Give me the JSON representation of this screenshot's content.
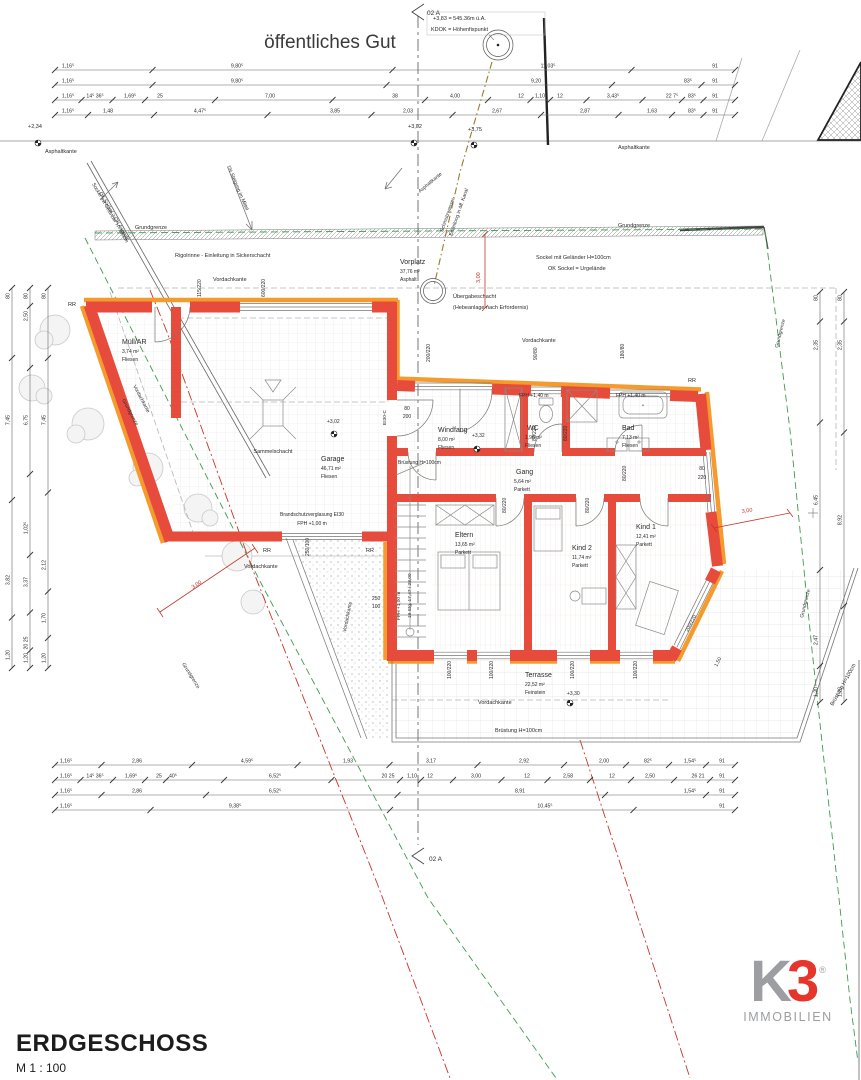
{
  "title": {
    "name": "ERDGESCHOSS",
    "scale": "M 1 : 100"
  },
  "logo": {
    "k": "K",
    "three": "3",
    "reg": "®",
    "sub": "IMMOBILIEN",
    "gray": "#9c9ea1",
    "red": "#e6352b"
  },
  "colors": {
    "wall_red": "#e64b3c",
    "insulation_orange": "#f59b2d",
    "dim_red": "#c0392b",
    "boundary_green": "#3f9b4f",
    "line_gray": "#555555",
    "text": "#2b2b2b"
  },
  "annotations": [
    {
      "t": "öffentliches Gut",
      "x": 330,
      "y": 48,
      "s": 19,
      "a": "middle",
      "c": "#3a3a3a"
    },
    {
      "t": "02 A",
      "x": 427,
      "y": 15,
      "s": 6.5
    },
    {
      "t": "+3,83 = 545.36m ü.A.",
      "x": 433,
      "y": 20,
      "s": 5.5
    },
    {
      "t": "KDOK = Höhenfixpunkt",
      "x": 431,
      "y": 31,
      "s": 5.5
    },
    {
      "t": "+2,34",
      "x": 28,
      "y": 128,
      "s": 5.5
    },
    {
      "t": "+3,02",
      "x": 408,
      "y": 128,
      "s": 5.5
    },
    {
      "t": "+3,75",
      "x": 468,
      "y": 131,
      "s": 5.5
    },
    {
      "t": "Asphaltkante",
      "x": 45,
      "y": 153,
      "s": 5.5
    },
    {
      "t": "Asphaltkante",
      "x": 618,
      "y": 149,
      "s": 5.5
    },
    {
      "t": "Asphaltkante",
      "x": 420,
      "y": 193,
      "s": 5,
      "r": -40
    },
    {
      "t": "Schmutzwasser-",
      "x": 443,
      "y": 232,
      "s": 5,
      "r": -71
    },
    {
      "t": "Einleitung in öff. Kanal",
      "x": 452,
      "y": 236,
      "s": 5,
      "r": -71
    },
    {
      "t": "1% Steigung im Mittel",
      "x": 227,
      "y": 166,
      "s": 5,
      "r": 67
    },
    {
      "t": "Sockel mit Geländer H=100cm",
      "x": 92,
      "y": 184,
      "s": 5,
      "r": 60
    },
    {
      "t": "OK Sockel > OK Asphalt",
      "x": 99,
      "y": 193,
      "s": 5,
      "r": 60
    },
    {
      "t": "Grundgrenze",
      "x": 135,
      "y": 229,
      "s": 5.5
    },
    {
      "t": "Grundgrenze",
      "x": 618,
      "y": 227,
      "s": 5.5
    },
    {
      "t": "Rigolrinne - Einleitung in Sickerschacht",
      "x": 175,
      "y": 257,
      "s": 5.5
    },
    {
      "t": "Sockel mit Geländer H=100cm",
      "x": 536,
      "y": 259,
      "s": 5.5
    },
    {
      "t": "OK Sockel = Urgelände",
      "x": 548,
      "y": 270,
      "s": 5.5
    },
    {
      "t": "Vorplatz",
      "x": 400,
      "y": 264,
      "s": 7
    },
    {
      "t": "37,76 m²",
      "x": 400,
      "y": 273,
      "s": 5
    },
    {
      "t": "Asphalt",
      "x": 400,
      "y": 281,
      "s": 5
    },
    {
      "t": "Übergabeschacht",
      "x": 453,
      "y": 298,
      "s": 5.5
    },
    {
      "t": "(Hebeanlage nach Erfordernis)",
      "x": 453,
      "y": 309,
      "s": 5.5
    },
    {
      "t": "3,00",
      "x": 480,
      "y": 283,
      "s": 5.5,
      "r": -90,
      "c": "#c0392b"
    },
    {
      "t": "Vordachkante",
      "x": 213,
      "y": 281,
      "s": 5.5
    },
    {
      "t": "Vordachkante",
      "x": 522,
      "y": 342,
      "s": 5.5
    },
    {
      "t": "Grundgrenze",
      "x": 778,
      "y": 348,
      "s": 5,
      "r": -76
    },
    {
      "t": "Grundgrenze",
      "x": 803,
      "y": 618,
      "s": 5,
      "r": -76
    },
    {
      "t": "Vordachkante",
      "x": 133,
      "y": 386,
      "s": 5,
      "r": 62
    },
    {
      "t": "Grundgrenze",
      "x": 122,
      "y": 400,
      "s": 5,
      "r": 62
    },
    {
      "t": "RR",
      "x": 68,
      "y": 306,
      "s": 5.5
    },
    {
      "t": "Müll/AR",
      "x": 122,
      "y": 344,
      "s": 7
    },
    {
      "t": "3,74 m²",
      "x": 122,
      "y": 353,
      "s": 5
    },
    {
      "t": "Fliesen",
      "x": 122,
      "y": 361,
      "s": 5
    },
    {
      "t": "115/220",
      "x": 201,
      "y": 297,
      "s": 5,
      "r": -90
    },
    {
      "t": "600/220",
      "x": 265,
      "y": 297,
      "s": 5,
      "r": -90
    },
    {
      "t": "Sammelschacht",
      "x": 273,
      "y": 453,
      "s": 5.5,
      "a": "middle"
    },
    {
      "t": "Garage",
      "x": 321,
      "y": 461,
      "s": 7
    },
    {
      "t": "46,71 m²",
      "x": 321,
      "y": 470,
      "s": 5
    },
    {
      "t": "Fliesen",
      "x": 321,
      "y": 478,
      "s": 5
    },
    {
      "t": "+3,02",
      "x": 327,
      "y": 423,
      "s": 5
    },
    {
      "t": "Brandschutzverglasung EI30",
      "x": 312,
      "y": 516,
      "s": 5,
      "a": "middle"
    },
    {
      "t": "FPH   +1,00 m",
      "x": 312,
      "y": 525,
      "s": 5,
      "a": "middle"
    },
    {
      "t": "EI30-C",
      "x": 386,
      "y": 425,
      "s": 4.8,
      "r": -90
    },
    {
      "t": "80",
      "x": 407,
      "y": 410,
      "s": 5,
      "a": "middle"
    },
    {
      "t": "200",
      "x": 407,
      "y": 418,
      "s": 5,
      "a": "middle"
    },
    {
      "t": "RR",
      "x": 263,
      "y": 552,
      "s": 5.5
    },
    {
      "t": "RR",
      "x": 366,
      "y": 552,
      "s": 5.5
    },
    {
      "t": "Vordachkante",
      "x": 244,
      "y": 568,
      "s": 5.5
    },
    {
      "t": "250/100",
      "x": 309,
      "y": 556,
      "s": 5,
      "r": -90
    },
    {
      "t": "250",
      "x": 372,
      "y": 600,
      "s": 5
    },
    {
      "t": "100",
      "x": 372,
      "y": 608,
      "s": 5
    },
    {
      "t": "Vordachkante",
      "x": 346,
      "y": 632,
      "s": 5,
      "r": -79
    },
    {
      "t": "3,00",
      "x": 193,
      "y": 589,
      "s": 5.5,
      "r": -34,
      "c": "#c0392b"
    },
    {
      "t": "Grundgrenze",
      "x": 182,
      "y": 664,
      "s": 5,
      "r": 58
    },
    {
      "t": "RR",
      "x": 688,
      "y": 382,
      "s": 5.5
    },
    {
      "t": "200/220",
      "x": 430,
      "y": 362,
      "s": 5,
      "r": -90
    },
    {
      "t": "90/80",
      "x": 537,
      "y": 360,
      "s": 5,
      "r": -90
    },
    {
      "t": "180/80",
      "x": 624,
      "y": 359,
      "s": 5,
      "r": -90
    },
    {
      "t": "Windfang",
      "x": 438,
      "y": 432,
      "s": 7
    },
    {
      "t": "8,00 m²",
      "x": 438,
      "y": 441,
      "s": 5
    },
    {
      "t": "Fliesen",
      "x": 438,
      "y": 449,
      "s": 5
    },
    {
      "t": "+3,32",
      "x": 472,
      "y": 437,
      "s": 5
    },
    {
      "t": "FPH   +1,40 m",
      "x": 519,
      "y": 397,
      "s": 5
    },
    {
      "t": "WC",
      "x": 527,
      "y": 430,
      "s": 7
    },
    {
      "t": "1,98 m²",
      "x": 525,
      "y": 439,
      "s": 5
    },
    {
      "t": "Fliesen",
      "x": 525,
      "y": 447,
      "s": 5
    },
    {
      "t": "FPH   +1,40 m",
      "x": 616,
      "y": 397,
      "s": 5
    },
    {
      "t": "Bad",
      "x": 622,
      "y": 430,
      "s": 7
    },
    {
      "t": "7,13 m²",
      "x": 622,
      "y": 439,
      "s": 5
    },
    {
      "t": "Fliesen",
      "x": 622,
      "y": 447,
      "s": 5
    },
    {
      "t": "Gang",
      "x": 516,
      "y": 474,
      "s": 7
    },
    {
      "t": "5,64 m²",
      "x": 514,
      "y": 483,
      "s": 5
    },
    {
      "t": "Parkett",
      "x": 514,
      "y": 491,
      "s": 5
    },
    {
      "t": "Brüstung H=100cm",
      "x": 398,
      "y": 464,
      "s": 5
    },
    {
      "t": "80/220",
      "x": 536,
      "y": 441,
      "s": 5,
      "r": -90
    },
    {
      "t": "80/220",
      "x": 567,
      "y": 441,
      "s": 5,
      "r": -90
    },
    {
      "t": "80/220",
      "x": 626,
      "y": 481,
      "s": 5,
      "r": -90
    },
    {
      "t": "80",
      "x": 702,
      "y": 470,
      "s": 5,
      "a": "middle"
    },
    {
      "t": "220",
      "x": 702,
      "y": 479,
      "s": 5,
      "a": "middle"
    },
    {
      "t": "80/220",
      "x": 506,
      "y": 513,
      "s": 5,
      "r": -90
    },
    {
      "t": "80/220",
      "x": 589,
      "y": 513,
      "s": 5,
      "r": -90
    },
    {
      "t": "Eltern",
      "x": 455,
      "y": 537,
      "s": 7
    },
    {
      "t": "13,65 m²",
      "x": 455,
      "y": 546,
      "s": 5
    },
    {
      "t": "Parkett",
      "x": 455,
      "y": 554,
      "s": 5
    },
    {
      "t": "Kind 2",
      "x": 572,
      "y": 550,
      "s": 7
    },
    {
      "t": "11,74 m²",
      "x": 572,
      "y": 559,
      "s": 5
    },
    {
      "t": "Parkett",
      "x": 572,
      "y": 567,
      "s": 5
    },
    {
      "t": "Kind 1",
      "x": 636,
      "y": 529,
      "s": 7
    },
    {
      "t": "12,41 m²",
      "x": 636,
      "y": 538,
      "s": 5
    },
    {
      "t": "Parkett",
      "x": 636,
      "y": 546,
      "s": 5
    },
    {
      "t": "19 Stg. 17,47 / 28,00",
      "x": 411,
      "y": 618,
      "s": 4.8,
      "r": -90
    },
    {
      "t": "FPH   +1,00 m",
      "x": 400,
      "y": 620,
      "s": 4.8,
      "r": -90
    },
    {
      "t": "100/220",
      "x": 451,
      "y": 679,
      "s": 5,
      "r": -90
    },
    {
      "t": "100/220",
      "x": 493,
      "y": 679,
      "s": 5,
      "r": -90
    },
    {
      "t": "100/220",
      "x": 574,
      "y": 679,
      "s": 5,
      "r": -90
    },
    {
      "t": "100/220",
      "x": 637,
      "y": 679,
      "s": 5,
      "r": -90
    },
    {
      "t": "Terrasse",
      "x": 525,
      "y": 677,
      "s": 7
    },
    {
      "t": "22,52 m²",
      "x": 525,
      "y": 686,
      "s": 5
    },
    {
      "t": "Feinstein",
      "x": 525,
      "y": 694,
      "s": 5
    },
    {
      "t": "+3,30",
      "x": 567,
      "y": 695,
      "s": 5
    },
    {
      "t": "Vordachkante",
      "x": 478,
      "y": 704,
      "s": 5.5
    },
    {
      "t": "Brüstung H=100cm",
      "x": 495,
      "y": 732,
      "s": 5.5
    },
    {
      "t": "Brüstung H=100cm",
      "x": 833,
      "y": 706,
      "s": 5.5,
      "r": -61
    },
    {
      "t": "200/220",
      "x": 688,
      "y": 632,
      "s": 5,
      "r": -63
    },
    {
      "t": "1,50",
      "x": 717,
      "y": 667,
      "s": 5,
      "r": -63
    },
    {
      "t": "3,00",
      "x": 742,
      "y": 513,
      "s": 5.5,
      "r": -8,
      "c": "#c0392b"
    },
    {
      "t": "02 A",
      "x": 429,
      "y": 861,
      "s": 6.5
    }
  ],
  "dims": {
    "top_rows": [
      {
        "y": 70,
        "labels": [
          {
            "t": "1,16⁵",
            "x": 68
          },
          {
            "t": "9,80⁵",
            "x": 237
          },
          {
            "t": "11,03⁵",
            "x": 548
          },
          {
            "t": "91",
            "x": 715
          }
        ]
      },
      {
        "y": 85,
        "labels": [
          {
            "t": "1,16⁵",
            "x": 68
          },
          {
            "t": "9,80⁵",
            "x": 237
          },
          {
            "t": "9,20",
            "x": 536
          },
          {
            "t": "83⁵",
            "x": 688
          },
          {
            "t": "91",
            "x": 715
          }
        ]
      },
      {
        "y": 100,
        "labels": [
          {
            "t": "1,16⁵",
            "x": 68
          },
          {
            "t": "14⁵ 36⁵",
            "x": 95
          },
          {
            "t": "1,69⁵",
            "x": 130
          },
          {
            "t": "25",
            "x": 160
          },
          {
            "t": "7,00",
            "x": 270
          },
          {
            "t": "38",
            "x": 395
          },
          {
            "t": "4,00",
            "x": 455
          },
          {
            "t": "12",
            "x": 521
          },
          {
            "t": "1,10",
            "x": 540
          },
          {
            "t": "12",
            "x": 560
          },
          {
            "t": "3,43⁵",
            "x": 613
          },
          {
            "t": "22 7⁵",
            "x": 672
          },
          {
            "t": "83⁵",
            "x": 692
          },
          {
            "t": "91",
            "x": 715
          }
        ]
      },
      {
        "y": 115,
        "labels": [
          {
            "t": "1,16⁵",
            "x": 68
          },
          {
            "t": "1,48",
            "x": 108
          },
          {
            "t": "4,47⁵",
            "x": 200
          },
          {
            "t": "3,85",
            "x": 335
          },
          {
            "t": "2,03",
            "x": 408
          },
          {
            "t": "2,67",
            "x": 497
          },
          {
            "t": "2,87",
            "x": 585
          },
          {
            "t": "1,63",
            "x": 652
          },
          {
            "t": "83⁵",
            "x": 692
          },
          {
            "t": "91",
            "x": 715
          }
        ]
      }
    ],
    "bottom_rows": [
      {
        "y": 765,
        "labels": [
          {
            "t": "1,16⁵",
            "x": 66
          },
          {
            "t": "2,86",
            "x": 137
          },
          {
            "t": "4,59⁵",
            "x": 247
          },
          {
            "t": "1,93",
            "x": 348
          },
          {
            "t": "3,17",
            "x": 431
          },
          {
            "t": "2,92",
            "x": 524
          },
          {
            "t": "2,00",
            "x": 604
          },
          {
            "t": "82⁵",
            "x": 648
          },
          {
            "t": "1,54⁵",
            "x": 690
          },
          {
            "t": "91",
            "x": 722
          }
        ]
      },
      {
        "y": 780,
        "labels": [
          {
            "t": "1,16⁵",
            "x": 66
          },
          {
            "t": "14⁵ 36⁵",
            "x": 95
          },
          {
            "t": "1,69⁵",
            "x": 131
          },
          {
            "t": "25",
            "x": 159
          },
          {
            "t": "40⁵",
            "x": 173
          },
          {
            "t": "6,52⁵",
            "x": 275
          },
          {
            "t": "20 25",
            "x": 388
          },
          {
            "t": "1,10",
            "x": 412
          },
          {
            "t": "12",
            "x": 430
          },
          {
            "t": "3,00",
            "x": 476
          },
          {
            "t": "12",
            "x": 527
          },
          {
            "t": "2,58",
            "x": 568
          },
          {
            "t": "12",
            "x": 612
          },
          {
            "t": "2,50",
            "x": 650
          },
          {
            "t": "26 21",
            "x": 698
          },
          {
            "t": "91",
            "x": 722
          }
        ]
      },
      {
        "y": 795,
        "labels": [
          {
            "t": "1,16⁵",
            "x": 66
          },
          {
            "t": "2,86",
            "x": 137
          },
          {
            "t": "6,52⁵",
            "x": 275
          },
          {
            "t": "8,91",
            "x": 520
          },
          {
            "t": "1,54⁵",
            "x": 690
          },
          {
            "t": "91",
            "x": 722
          }
        ]
      },
      {
        "y": 810,
        "labels": [
          {
            "t": "1,16⁵",
            "x": 66
          },
          {
            "t": "9,38⁵",
            "x": 235
          },
          {
            "t": "10,45⁵",
            "x": 545
          },
          {
            "t": "91",
            "x": 722
          }
        ]
      }
    ],
    "left_cols": [
      {
        "x": 12,
        "labels": [
          {
            "t": "80",
            "y": 296
          },
          {
            "t": "7,45",
            "y": 420
          },
          {
            "t": "3,82",
            "y": 580
          },
          {
            "t": "1,20",
            "y": 655
          }
        ]
      },
      {
        "x": 30,
        "labels": [
          {
            "t": "80",
            "y": 296
          },
          {
            "t": "2,50",
            "y": 316
          },
          {
            "t": "6,75",
            "y": 420
          },
          {
            "t": "1,02⁵",
            "y": 528
          },
          {
            "t": "3,37",
            "y": 582
          },
          {
            "t": "20 25",
            "y": 643
          },
          {
            "t": "1,20",
            "y": 658
          }
        ]
      },
      {
        "x": 48,
        "labels": [
          {
            "t": "80",
            "y": 296
          },
          {
            "t": "7,45",
            "y": 420
          },
          {
            "t": "2,12",
            "y": 565
          },
          {
            "t": "1,70",
            "y": 618
          },
          {
            "t": "1,20",
            "y": 658
          }
        ]
      }
    ],
    "right_cols": [
      {
        "x": 820,
        "labels": [
          {
            "t": "80",
            "y": 298
          },
          {
            "t": "2,35",
            "y": 345
          },
          {
            "t": "6,45",
            "y": 500
          },
          {
            "t": "2,47",
            "y": 640
          },
          {
            "t": "1,20",
            "y": 692
          }
        ]
      },
      {
        "x": 844,
        "labels": [
          {
            "t": "80",
            "y": 298
          },
          {
            "t": "2,35",
            "y": 345
          },
          {
            "t": "8,92",
            "y": 520
          },
          {
            "t": "1,20",
            "y": 692
          }
        ]
      }
    ]
  }
}
